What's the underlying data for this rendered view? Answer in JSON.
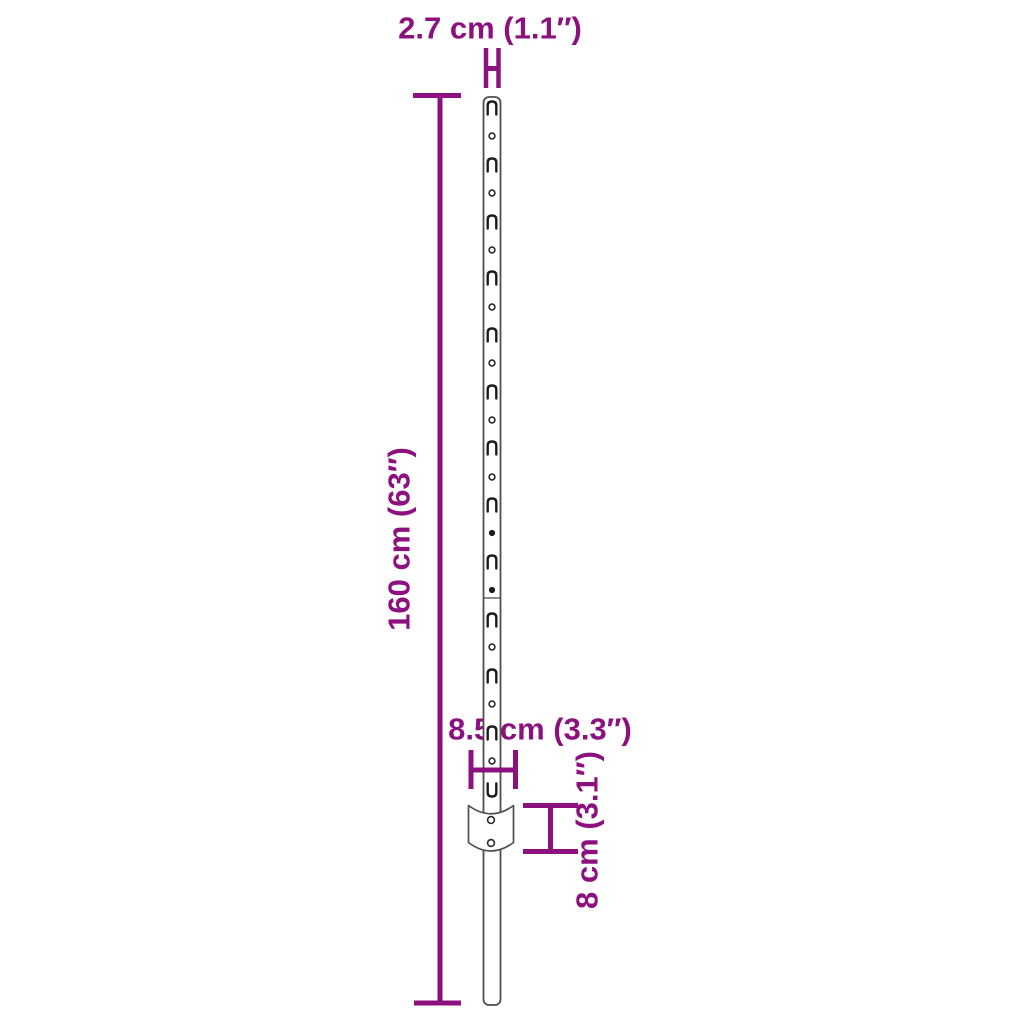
{
  "page": {
    "type": "product-dimension-diagram",
    "background": "#ffffff"
  },
  "colors": {
    "dimension": "#8D107F",
    "outline": "#4f4f4f",
    "feature": "#1c1c1c",
    "fill": "#ffffff"
  },
  "labels": {
    "top_width": "2.7 cm (1.1″)",
    "height": "160 cm (63″)",
    "plate_width": "8.5 cm (3.3″)",
    "plate_height": "8 cm (3.1″)"
  },
  "diagram": {
    "post": {
      "slot_ys": [
        108,
        165,
        222,
        278,
        335,
        392,
        448,
        505,
        562,
        620,
        676,
        733
      ],
      "u_slot_y": 790,
      "hole_ys": [
        136,
        193,
        250,
        307,
        363,
        420,
        477,
        647,
        704,
        761
      ],
      "filled_hole_ys": [
        533,
        590
      ],
      "seam_y": 598,
      "slot_count": 13,
      "hole_count": 12
    },
    "plate": {
      "hole_count": 2
    }
  }
}
